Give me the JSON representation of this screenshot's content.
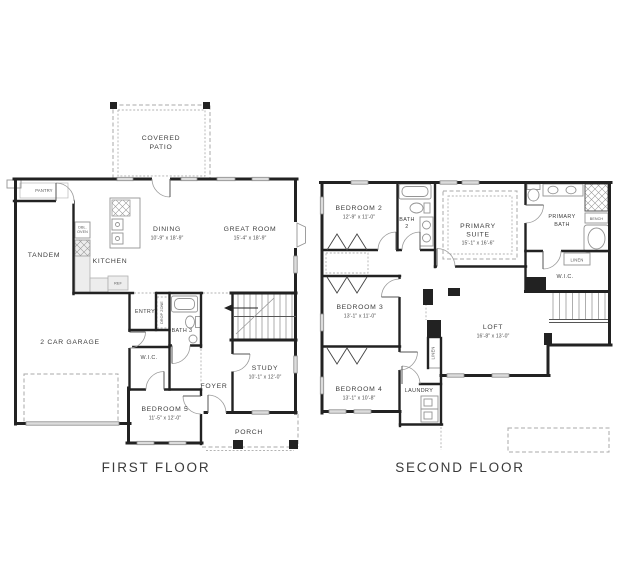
{
  "titles": {
    "first_floor": "FIRST FLOOR",
    "second_floor": "SECOND FLOOR"
  },
  "colors": {
    "background": "#ffffff",
    "wall": "#222222",
    "fixture_line": "#949494",
    "window_fill": "#dcdcdc",
    "dashed_line": "#a8a8a8",
    "label_text": "#3e3e3e"
  },
  "first_floor": {
    "covered_patio": {
      "line1": "COVERED",
      "line2": "PATIO"
    },
    "pantry": {
      "name": "PANTRY"
    },
    "tandem": {
      "name": "TANDEM"
    },
    "dbl_oven": {
      "line1": "DBL.",
      "line2": "OVEN"
    },
    "kitchen": {
      "name": "KITCHEN"
    },
    "ref": {
      "name": "REF"
    },
    "dining": {
      "name": "DINING",
      "dims": "10'-9\" x 18'-9\""
    },
    "great_room": {
      "name": "GREAT ROOM",
      "dims": "15'-4\" x 18'-9\""
    },
    "garage": {
      "name": "2 CAR GARAGE"
    },
    "entry": {
      "name": "ENTRY"
    },
    "drop_zone": {
      "name": "DROP ZONE"
    },
    "bath_3": {
      "name": "BATH 3"
    },
    "wic": {
      "name": "W.I.C."
    },
    "study": {
      "name": "STUDY",
      "dims": "10'-1\" x 12'-0\""
    },
    "foyer": {
      "name": "FOYER"
    },
    "bedroom_5": {
      "name": "BEDROOM 5",
      "dims": "11'-5\" x 12'-0\""
    },
    "porch": {
      "name": "PORCH"
    }
  },
  "second_floor": {
    "bedroom_2": {
      "name": "BEDROOM 2",
      "dims": "12'-9\" x 11'-0\""
    },
    "bath_2": {
      "line1": "BATH",
      "line2": "2"
    },
    "primary_suite": {
      "line1": "PRIMARY",
      "line2": "SUITE",
      "dims": "15'-1\" x 16'-6\""
    },
    "primary_bath": {
      "line1": "PRIMARY",
      "line2": "BATH"
    },
    "bench": {
      "name": "BENCH"
    },
    "linen_wic": {
      "name": "LINEN"
    },
    "wic": {
      "name": "W.I.C."
    },
    "bedroom_3": {
      "name": "BEDROOM 3",
      "dims": "13'-1\" x 11'-0\""
    },
    "loft": {
      "name": "LOFT",
      "dims": "16'-8\" x 13'-0\""
    },
    "linen_hall": {
      "name": "LINEN"
    },
    "bedroom_4": {
      "name": "BEDROOM 4",
      "dims": "13'-1\" x 10'-8\""
    },
    "laundry": {
      "name": "LAUNDRY"
    }
  }
}
